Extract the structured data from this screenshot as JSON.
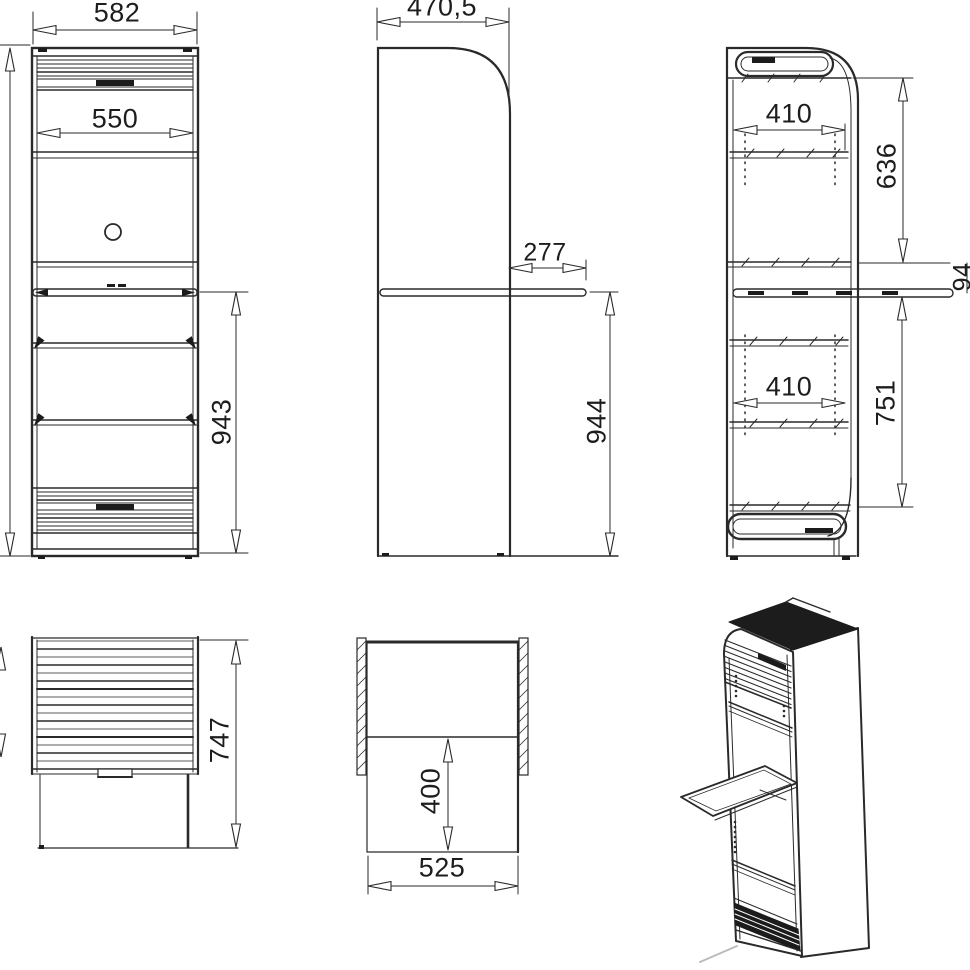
{
  "colors": {
    "background": "#ffffff",
    "line": "#2a2a2a",
    "dark_fill": "#1c1c1c"
  },
  "dims": {
    "overall_width": "582",
    "door_clear_width": "550",
    "front_height": "943",
    "depth": "470,5",
    "tray_extension": "277",
    "height_to_tray": "944",
    "shelf_width_upper": "410",
    "top_to_rail": "636",
    "rail_to_tray": "94",
    "shelf_width_lower": "410",
    "tray_to_bottom_shelf": "751",
    "lower_section_height": "747",
    "plan_inner_depth": "400",
    "plan_inner_width": "525"
  }
}
